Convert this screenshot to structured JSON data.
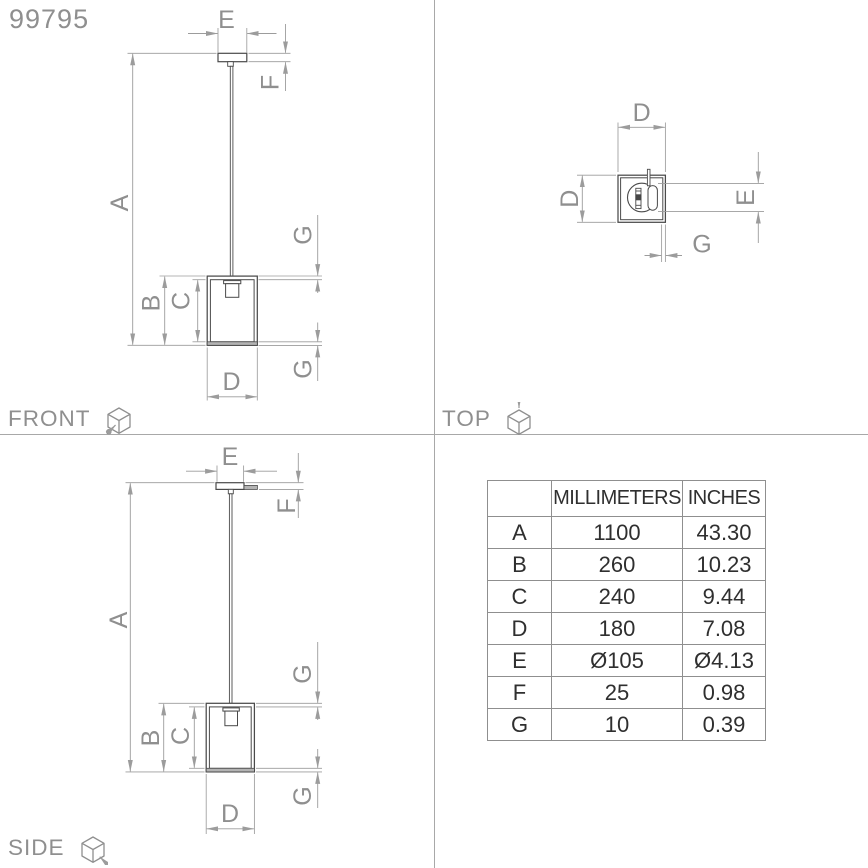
{
  "product_code": "99795",
  "views": {
    "front": {
      "label": "FRONT"
    },
    "top": {
      "label": "TOP"
    },
    "side": {
      "label": "SIDE"
    }
  },
  "dims": {
    "A": "A",
    "B": "B",
    "C": "C",
    "D": "D",
    "E": "E",
    "F": "F",
    "G": "G"
  },
  "table": {
    "headers": [
      "",
      "MILLIMETERS",
      "INCHES"
    ],
    "rows": [
      {
        "key": "A",
        "mm": "1100",
        "inches": "43.30"
      },
      {
        "key": "B",
        "mm": "260",
        "inches": "10.23"
      },
      {
        "key": "C",
        "mm": "240",
        "inches": "9.44"
      },
      {
        "key": "D",
        "mm": "180",
        "inches": "7.08"
      },
      {
        "key": "E",
        "mm": "Ø105",
        "inches": "Ø4.13"
      },
      {
        "key": "F",
        "mm": "25",
        "inches": "0.98"
      },
      {
        "key": "G",
        "mm": "10",
        "inches": "0.39"
      }
    ]
  },
  "colors": {
    "background": "#ffffff",
    "object_line": "#4a4a4a",
    "dimension_line": "#9c9c9c",
    "label_text": "#8f8f8f",
    "table_text": "#2f2f2f",
    "table_border": "#8f8f8f",
    "fill_gray": "#b3b3b3"
  }
}
